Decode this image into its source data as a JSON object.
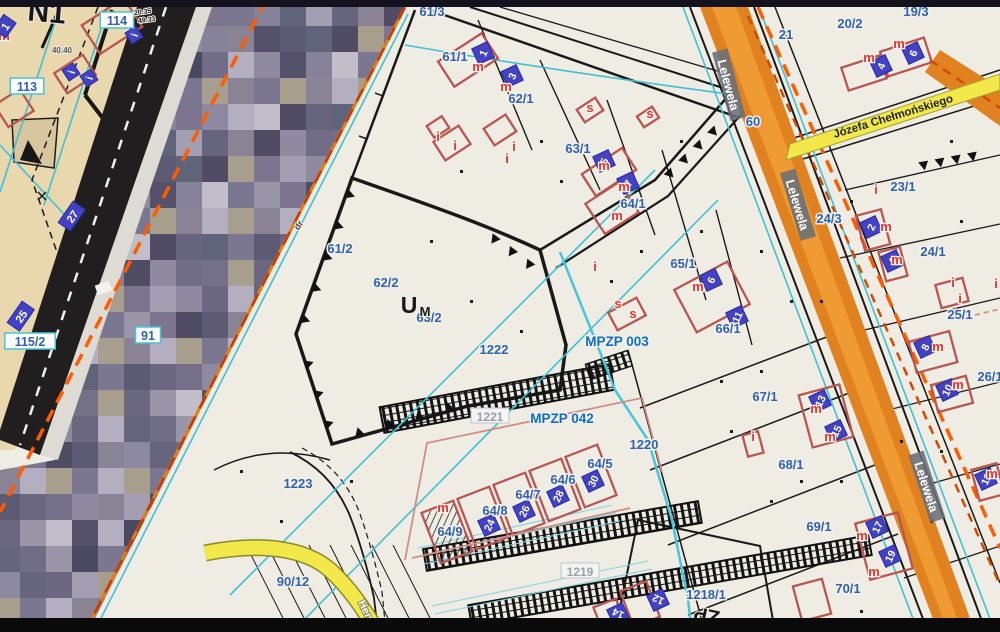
{
  "title": "Cadastral map viewer with zoning plans (MPZP)",
  "colors": {
    "map_background": "#efece3",
    "beige_area": "#e9d7ae",
    "parcel_label_blue": "#2f62b0",
    "mpzp_label_blue": "#0d6ec6",
    "building_outline_red": "#b85650",
    "red_letter": "#e4322e",
    "number_square_indigo": "#4242c4",
    "cyan_line": "#3fc0d4",
    "orange_road": "#e0821f",
    "orange_dash": "#ff5c00",
    "yellow_road": "#f3e84a",
    "street_label_box_gray": "#6a6e78",
    "top_bar": "#14121c",
    "bottom_bar": "#0a0a0a"
  },
  "streets": [
    {
      "text": "Lelewela",
      "x": 728,
      "y": 85,
      "rot": 75,
      "box": true
    },
    {
      "text": "Lelewela",
      "x": 797,
      "y": 205,
      "rot": 73,
      "box": true
    },
    {
      "text": "Lelewela",
      "x": 926,
      "y": 487,
      "rot": 72,
      "box": true
    },
    {
      "text": "Józefa Chełmońskiego",
      "x": 893,
      "y": 116,
      "rot": -17,
      "cls": "chelm"
    },
    {
      "text": "Hen",
      "x": 366,
      "y": 610,
      "rot": 64,
      "cls": "hen"
    }
  ],
  "labels": {
    "parcels": [
      {
        "t": "61/3",
        "x": 432,
        "y": 16
      },
      {
        "t": "61/1",
        "x": 455,
        "y": 61
      },
      {
        "t": "62/1",
        "x": 521,
        "y": 103
      },
      {
        "t": "63/1",
        "x": 578,
        "y": 153
      },
      {
        "t": "64/1",
        "x": 633,
        "y": 208
      },
      {
        "t": "65/1",
        "x": 683,
        "y": 268
      },
      {
        "t": "66/1",
        "x": 728,
        "y": 333
      },
      {
        "t": "67/1",
        "x": 765,
        "y": 401
      },
      {
        "t": "68/1",
        "x": 791,
        "y": 469
      },
      {
        "t": "69/1",
        "x": 819,
        "y": 531
      },
      {
        "t": "70/1",
        "x": 848,
        "y": 593
      },
      {
        "t": "61/2",
        "x": 340,
        "y": 253
      },
      {
        "t": "62/2",
        "x": 386,
        "y": 287
      },
      {
        "t": "63/2",
        "x": 429,
        "y": 322
      },
      {
        "t": "1222",
        "x": 494,
        "y": 354
      },
      {
        "t": "1220",
        "x": 644,
        "y": 449
      },
      {
        "t": "1223",
        "x": 298,
        "y": 488
      },
      {
        "t": "90/12",
        "x": 293,
        "y": 586
      },
      {
        "t": "64/5",
        "x": 600,
        "y": 468
      },
      {
        "t": "64/6",
        "x": 563,
        "y": 484
      },
      {
        "t": "64/7",
        "x": 528,
        "y": 499
      },
      {
        "t": "64/8",
        "x": 495,
        "y": 515
      },
      {
        "t": "64/9",
        "x": 450,
        "y": 536
      },
      {
        "t": "19/3",
        "x": 916,
        "y": 16
      },
      {
        "t": "20/2",
        "x": 850,
        "y": 28
      },
      {
        "t": "21",
        "x": 786,
        "y": 39
      },
      {
        "t": "60",
        "x": 753,
        "y": 126
      },
      {
        "t": "23/1",
        "x": 903,
        "y": 191
      },
      {
        "t": "24/3",
        "x": 829,
        "y": 223
      },
      {
        "t": "24/1",
        "x": 933,
        "y": 256
      },
      {
        "t": "25/1",
        "x": 960,
        "y": 319
      },
      {
        "t": "26/1",
        "x": 990,
        "y": 381
      },
      {
        "t": "1218/1",
        "x": 706,
        "y": 599
      }
    ],
    "mpzp": [
      {
        "t": "MPZP 003",
        "x": 617,
        "y": 346
      },
      {
        "t": "MPZP 042",
        "x": 562,
        "y": 423
      }
    ],
    "plates_white": [
      {
        "t": "114",
        "x": 117,
        "y": 23
      },
      {
        "t": "113",
        "x": 27,
        "y": 89
      },
      {
        "t": "115/2",
        "x": 30,
        "y": 344
      },
      {
        "t": "91",
        "x": 148,
        "y": 338
      }
    ],
    "plates_indigo": [
      {
        "t": "25",
        "x": 22,
        "y": 317,
        "rot": -55
      },
      {
        "t": "27",
        "x": 73,
        "y": 217,
        "rot": -55
      },
      {
        "t": "1",
        "x": 6,
        "y": 27,
        "rot": -55
      }
    ],
    "plates_gray": [
      {
        "t": "1221",
        "x": 490,
        "y": 418
      },
      {
        "t": "1219",
        "x": 580,
        "y": 573
      }
    ],
    "black": [
      {
        "t": "N1",
        "x": 46,
        "y": 22,
        "s": 30,
        "rot": 5
      },
      {
        "t": "U",
        "x": 409,
        "y": 313,
        "s": 23
      },
      {
        "t": "M",
        "x": 425,
        "y": 316,
        "s": 13
      },
      {
        "t": "ZP",
        "x": 708,
        "y": 609,
        "s": 20,
        "rot": 192
      },
      {
        "t": "dr",
        "x": 301,
        "y": 227,
        "s": 9,
        "rot": -55,
        "c": "#444"
      },
      {
        "t": "40.40",
        "x": 62,
        "y": 53,
        "s": 8,
        "c": "#555"
      },
      {
        "t": "20.35",
        "x": 143,
        "y": 14,
        "s": 7,
        "rot": -8,
        "c": "#222"
      },
      {
        "t": "49.33",
        "x": 147,
        "y": 22,
        "s": 7,
        "rot": -8,
        "c": "#222"
      }
    ]
  },
  "buildings": {
    "number_squares": [
      {
        "n": "1",
        "x": 483,
        "y": 53
      },
      {
        "n": "3",
        "x": 512,
        "y": 76
      },
      {
        "n": "5",
        "x": 604,
        "y": 161
      },
      {
        "n": "7",
        "x": 628,
        "y": 183
      },
      {
        "n": "6",
        "x": 711,
        "y": 280
      },
      {
        "n": "11",
        "x": 737,
        "y": 317
      },
      {
        "n": "6",
        "x": 913,
        "y": 53
      },
      {
        "n": "4",
        "x": 881,
        "y": 66
      },
      {
        "n": "2",
        "x": 871,
        "y": 227
      },
      {
        "n": "4",
        "x": 892,
        "y": 261
      },
      {
        "n": "8",
        "x": 925,
        "y": 347
      },
      {
        "n": "10",
        "x": 947,
        "y": 390
      },
      {
        "n": "13",
        "x": 820,
        "y": 401
      },
      {
        "n": "15",
        "x": 836,
        "y": 431
      },
      {
        "n": "17",
        "x": 877,
        "y": 527
      },
      {
        "n": "19",
        "x": 890,
        "y": 556
      },
      {
        "n": "12",
        "x": 986,
        "y": 479
      },
      {
        "n": "30",
        "x": 593,
        "y": 481
      },
      {
        "n": "28",
        "x": 558,
        "y": 496
      },
      {
        "n": "26",
        "x": 524,
        "y": 511
      },
      {
        "n": "24",
        "x": 489,
        "y": 525
      },
      {
        "n": "12",
        "x": 658,
        "y": 600,
        "rot": -115
      },
      {
        "n": "14",
        "x": 618,
        "y": 614,
        "rot": -115
      },
      {
        "n": "i",
        "x": 134,
        "y": 35,
        "s": 13,
        "rot": -33
      },
      {
        "n": "i",
        "x": 71,
        "y": 72,
        "s": 13,
        "rot": -33
      },
      {
        "n": "i",
        "x": 89,
        "y": 78,
        "s": 13,
        "rot": -33
      }
    ],
    "letters": {
      "m": [
        [
          478,
          71
        ],
        [
          506,
          91
        ],
        [
          604,
          170
        ],
        [
          624,
          191
        ],
        [
          617,
          220
        ],
        [
          698,
          291
        ],
        [
          899,
          48
        ],
        [
          869,
          62
        ],
        [
          886,
          231
        ],
        [
          897,
          264
        ],
        [
          938,
          351
        ],
        [
          958,
          389
        ],
        [
          816,
          413
        ],
        [
          830,
          441
        ],
        [
          862,
          540
        ],
        [
          874,
          576
        ],
        [
          992,
          478
        ],
        [
          443,
          512
        ],
        [
          4,
          40
        ]
      ],
      "i": [
        [
          438,
          141
        ],
        [
          455,
          150
        ],
        [
          514,
          151
        ],
        [
          507,
          163
        ],
        [
          876,
          194
        ],
        [
          595,
          271
        ],
        [
          753,
          441
        ],
        [
          953,
          287
        ],
        [
          960,
          303
        ],
        [
          996,
          288
        ]
      ],
      "s": [
        [
          590,
          112
        ],
        [
          650,
          118
        ],
        [
          618,
          308
        ],
        [
          633,
          318
        ]
      ]
    }
  },
  "mosaic_palette": [
    "#6b6780",
    "#55516b",
    "#8d89a1",
    "#7b7790",
    "#a49eb2",
    "#4f4c63",
    "#747088",
    "#9a95a9",
    "#b3aec0",
    "#5d5a73",
    "#868299",
    "#67647d",
    "#8f8aa0",
    "#a79e8e",
    "#c2bec9",
    "#4b4861",
    "#7d7490",
    "#5f647a",
    "#8a8396",
    "#716d86"
  ]
}
